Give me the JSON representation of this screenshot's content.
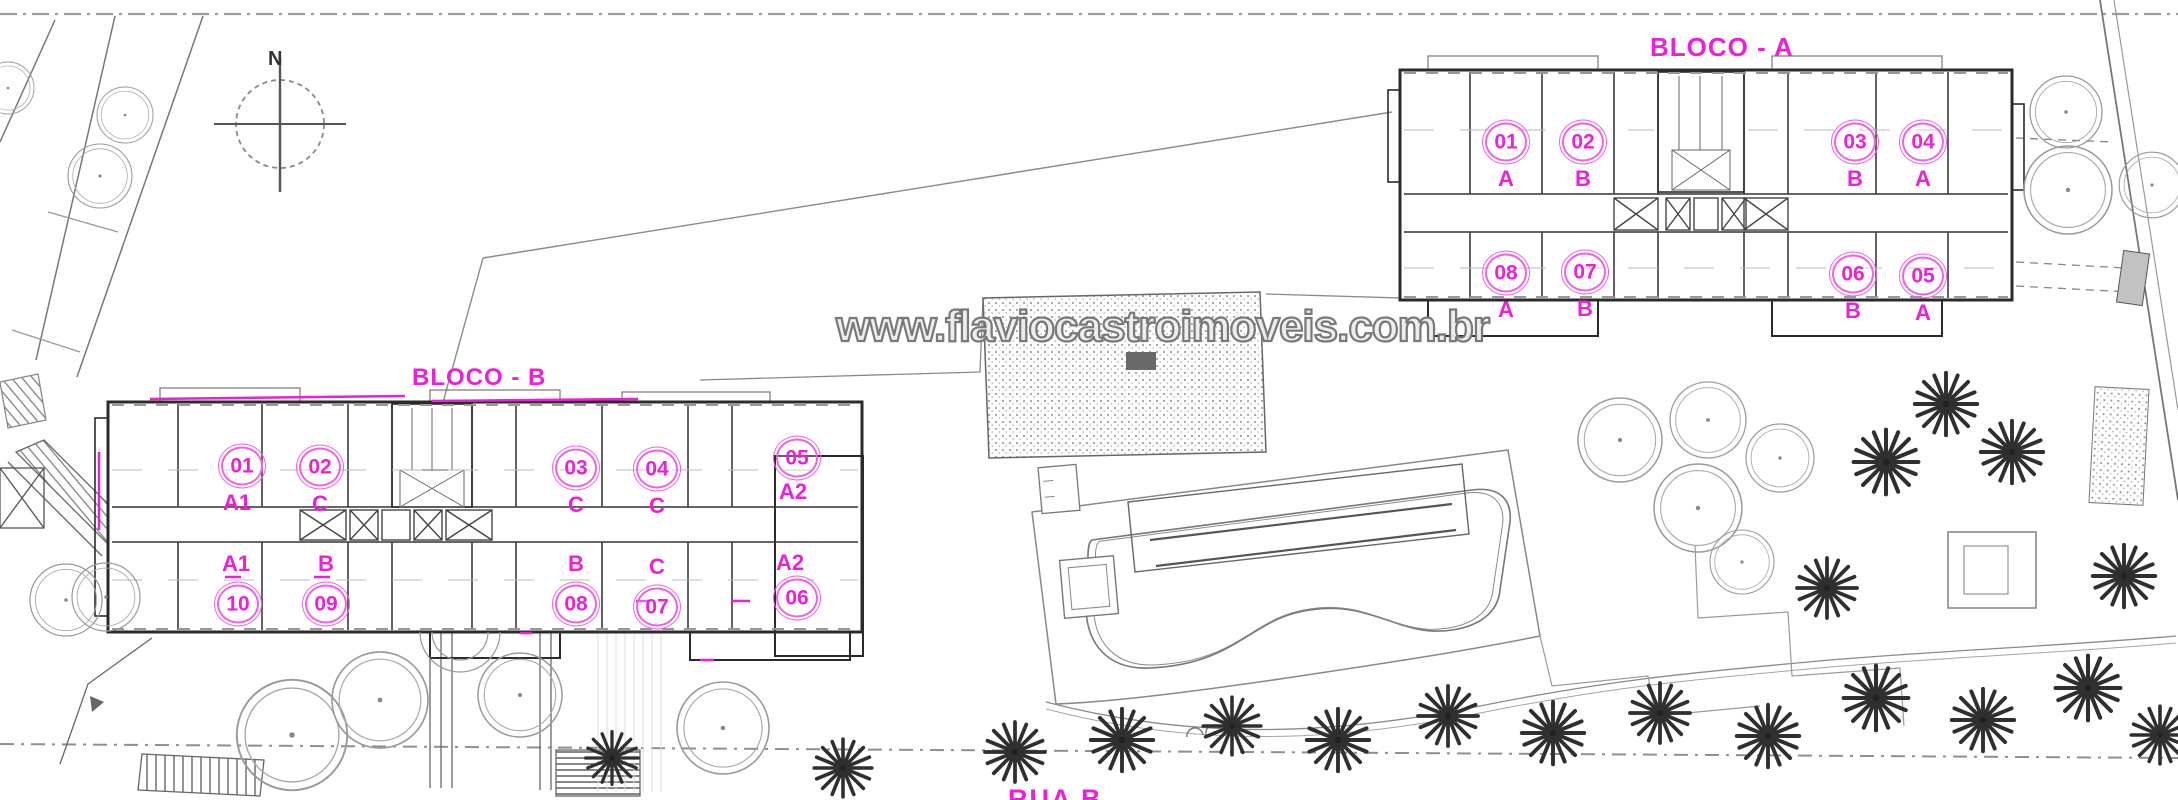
{
  "watermark": {
    "text": "www.flaviocastroimoveis.com.br"
  },
  "north_indicator": {
    "label": "N"
  },
  "street_label": {
    "text": "RUA B"
  },
  "colors": {
    "annotation_magenta": "#ee1fd8",
    "annotation_magenta_light": "#f261e2",
    "watermark_gray": "#757575",
    "wall_dark": "#2b2b2b",
    "line_mid": "#555555"
  },
  "features": {
    "pool": "swimming-pool",
    "round_trees": "round-canopy-tree-icon",
    "palm_trees": "palm-tree-icon",
    "north_arrow": "compass-north-icon"
  },
  "blocks": [
    {
      "label": "BLOCO - A",
      "units": [
        {
          "number": "01",
          "letter": "A"
        },
        {
          "number": "02",
          "letter": "B"
        },
        {
          "number": "03",
          "letter": "B"
        },
        {
          "number": "04",
          "letter": "A"
        },
        {
          "number": "08",
          "letter": "A"
        },
        {
          "number": "07",
          "letter": "B"
        },
        {
          "number": "06",
          "letter": "B"
        },
        {
          "number": "05",
          "letter": "A"
        }
      ]
    },
    {
      "label": "BLOCO - B",
      "units": [
        {
          "number": "01",
          "letter": "A1"
        },
        {
          "number": "02",
          "letter": "C"
        },
        {
          "number": "03",
          "letter": "C"
        },
        {
          "number": "04",
          "letter": "C"
        },
        {
          "number": "05",
          "letter": "A2"
        },
        {
          "number": "10",
          "letter": "A1"
        },
        {
          "number": "09",
          "letter": "B"
        },
        {
          "number": "08",
          "letter": "B"
        },
        {
          "number": "07",
          "letter": "C"
        },
        {
          "number": "06",
          "letter": "A2"
        }
      ]
    }
  ]
}
